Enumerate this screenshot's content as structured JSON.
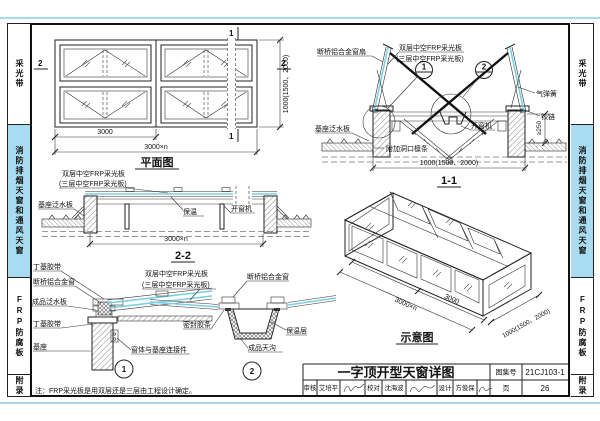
{
  "sidebar": {
    "tabs": [
      "采光带",
      "消防排烟天窗和通风天窗",
      "FRP防腐板",
      "附录"
    ]
  },
  "common": {
    "panel_double": "双层中空FRP采光板",
    "panel_triple": "(三层中空FRP采光板)",
    "window": "断桥铝合金窗",
    "opener": "开窗机",
    "base_flashing": "基座泛水板",
    "dim_width": "1000(1500、2000)",
    "dim_bay": "3000",
    "dim_total": "3000×n"
  },
  "plan": {
    "title": "平面图",
    "mark1": "1",
    "mark2": "2"
  },
  "sec11": {
    "title": "1-1",
    "sash_label": "断桥铝合金窗扇",
    "gas_spring": "气弹簧",
    "hinge": "铰链",
    "purlin": "附加洞口檩条",
    "dim_min": "≥250",
    "callout1": "1",
    "callout2": "2"
  },
  "sec22": {
    "title": "2-2",
    "insulation": "保温"
  },
  "det1": {
    "num": "1",
    "tape_top": "丁基胶带",
    "flashing": "成品泛水板",
    "tape_bottom": "丁基胶带",
    "base": "基座",
    "connector": "窗体与基座连接件"
  },
  "det2": {
    "num": "2",
    "seal": "密封胶条",
    "insulation": "保温层",
    "gutter": "成品天沟"
  },
  "iso": {
    "title": "示意图"
  },
  "note": "注：FRP采光板是用双层还是三层由工程设计确定。",
  "titleblock": {
    "title": "一字顶开型天窗详图",
    "atlas_label": "图集号",
    "atlas_no": "21CJ103-1",
    "page_label": "页",
    "page_no": "26",
    "review_label": "审核",
    "reviewer": "艾培平",
    "proof_label": "校对",
    "proofer": "沈海波",
    "design_label": "设计",
    "designer": "方俊保"
  }
}
